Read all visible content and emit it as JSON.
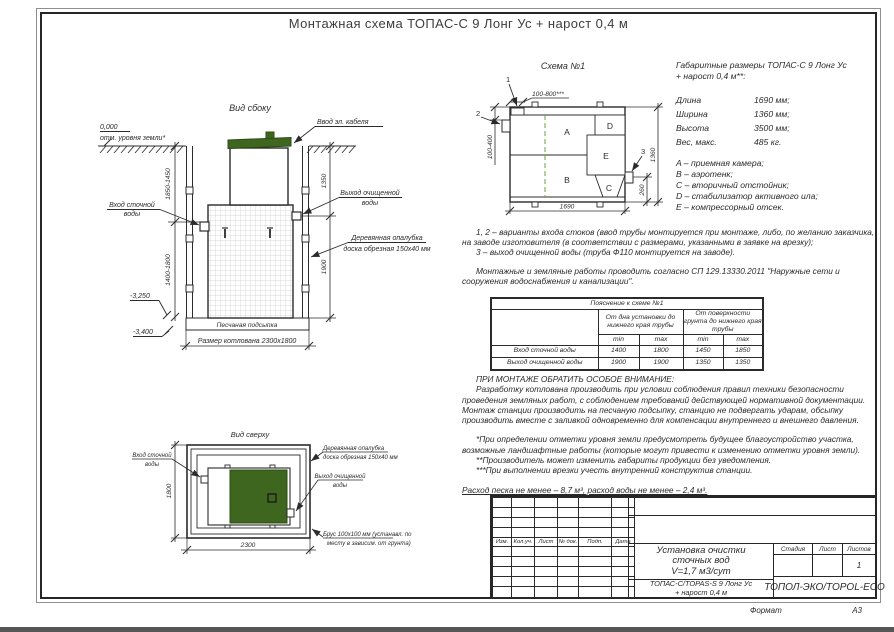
{
  "doc": {
    "title": "Монтажная схема ТОПАС-С 9 Лонг Ус + нарост 0,4 м",
    "format_label": "Формат",
    "format_value": "А3"
  },
  "side_view": {
    "title": "Вид сбоку",
    "ground_mark": "0,000",
    "ground_note": "отм. уровня земли*",
    "cable_label": "Ввод эл. кабеля",
    "inlet_l1": "Вход сточной",
    "inlet_l2": "воды",
    "outlet_l1": "Выход очищенной",
    "outlet_l2": "воды",
    "formwork_l1": "Деревянная опалубка",
    "formwork_l2": "доска обрезная 150x40 мм",
    "sand_label": "Песчаная подсыпка",
    "pit_label": "Размер котлована 2300x1800",
    "dim_depth_top": "1850-1450",
    "dim_depth_bottom": "1400-1800",
    "dim_1350": "1350",
    "dim_1900": "1900",
    "level_sand": "-3,250",
    "level_bottom": "-3,400"
  },
  "schema": {
    "title": "Схема №1",
    "m1": "1",
    "m2": "2",
    "m3": "3",
    "dim_top": "100-800***",
    "dim_left": "100-400",
    "dim_height": "1360",
    "dim_260": "260",
    "dim_length": "1690",
    "cA": "A",
    "cB": "B",
    "cC": "C",
    "cD": "D",
    "cE": "E"
  },
  "specs": {
    "heading_l1": "Габаритные размеры ТОПАС-С 9 Лонг Ус",
    "heading_l2": "+ нарост 0,4 м**:",
    "rows": [
      {
        "label": "Длина",
        "value": "1690 мм;"
      },
      {
        "label": "Ширина",
        "value": "1360 мм;"
      },
      {
        "label": "Высота",
        "value": "3500 мм;"
      },
      {
        "label": "Вес, макс.",
        "value": "485 кг."
      }
    ],
    "legend": [
      "A – приемная камера;",
      "B – аэротенк;",
      "C – вторичный отстойник;",
      "D – стабилизатор активного ила;",
      "E – компрессорный отсек."
    ]
  },
  "notes": {
    "p1": "1, 2 – варианты входа стоков (ввод трубы монтируется при монтаже, либо, по желанию заказчика, на заводе изготовителя (в соответствии с размерами, указанными в заявке на врезку);",
    "p2": "3 – выход очищенной воды (труба Ф110 монтируется на заводе).",
    "p3": "Монтажные и земляные работы проводить согласно СП 129.13330.2011 \"Наружные сети и сооружения водоснабжения и канализации\"."
  },
  "table": {
    "title": "Пояснение к схеме №1",
    "group1": "От дна установки до нижнего края трубы",
    "group2": "От поверхности грунта до нижнего края трубы",
    "min1": "min",
    "max1": "max",
    "min2": "min",
    "max2": "max",
    "rows": [
      {
        "label": "Вход сточной воды",
        "c1": "1400",
        "c2": "1800",
        "c3": "1450",
        "c4": "1850"
      },
      {
        "label": "Выход очищенной воды",
        "c1": "1900",
        "c2": "1900",
        "c3": "1350",
        "c4": "1350"
      }
    ]
  },
  "attention": {
    "heading": "ПРИ МОНТАЖЕ ОБРАТИТЬ ОСОБОЕ ВНИМАНИЕ:",
    "p1": "Разработку котлована производить при условии соблюдения правил техники безопасности проведения земляных работ, с соблюдением требований действующей нормативной документации. Монтаж станции производить на песчаную подсыпку, станцию не подвергать ударам, обсыпку производить вместе с заливкой одновременно для компенсации внутреннего и внешнего давления.",
    "n1": "*При определении отметки уровня земли предусмотреть будущее благоустройство участка, возможные ландшафтные работы (которые могут привести к изменению отметки уровня земли).",
    "n2": "**Производитель может изменить габариты продукции без уведомления.",
    "n3": "***При выполнении врезки учесть внутренний конструктив станции.",
    "consumption": "Расход песка не менее – 8,7 м³, расход воды не менее – 2,4 м³."
  },
  "top_view": {
    "title": "Вид сверху",
    "inlet_l1": "Вход сточной",
    "inlet_l2": "воды",
    "formwork_l1": "Деревянная опалубка",
    "formwork_l2": "доска обрезная 150x40 мм",
    "outlet_l1": "Выход очищенной",
    "outlet_l2": "воды",
    "beam_l1": "Брус 100x100 мм (устанавл. по",
    "beam_l2": "месту в зависим. от грунта)",
    "dim_width": "1800",
    "dim_length": "2300"
  },
  "stamp": {
    "rev_cols": [
      "Изм.",
      "Кол.уч.",
      "Лист",
      "№ док.",
      "Подп.",
      "Дата"
    ],
    "title_l1": "Установка очистки",
    "title_l2": "сточных вод",
    "title_l3": "V=1,7 м3/сут",
    "stage_label": "Стадия",
    "sheet_label": "Лист",
    "sheets_label": "Листов",
    "sheets_value": "1",
    "model_l1": "ТОПАС-С/TOPAS-S 9 Лонг Ус",
    "model_l2": "+ нарост 0,4 м",
    "company": "ТОПОЛ-ЭКО/TOPOL-ECO"
  },
  "colors": {
    "green": "#3e661e",
    "green_dark": "#2c4c12",
    "line": "#2b2b2b"
  }
}
